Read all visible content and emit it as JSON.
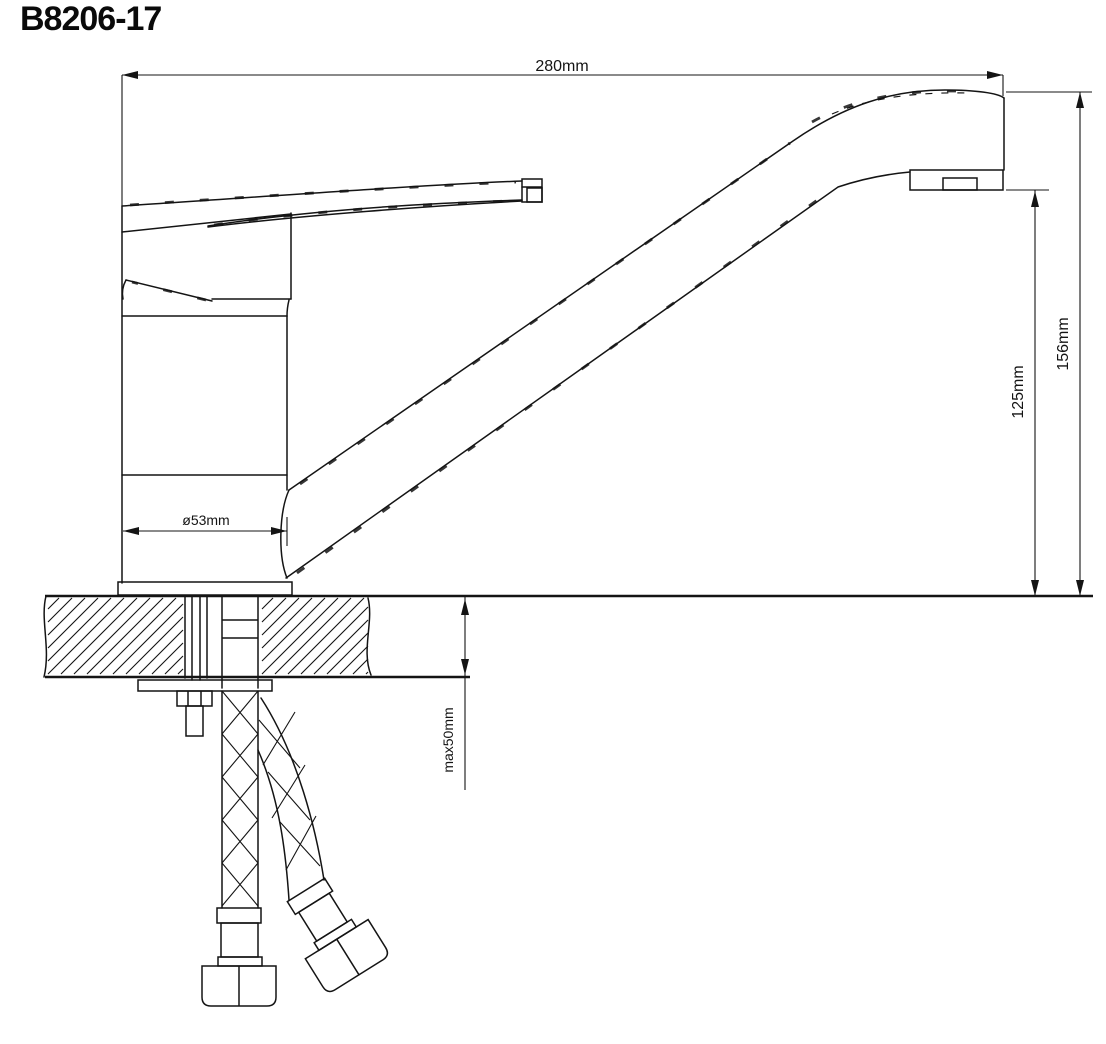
{
  "title": "B8206-17",
  "drawing_type": "faucet-installation-dimension-drawing",
  "dimensions": {
    "overall_width": "280mm",
    "total_height": "156mm",
    "spout_outlet_height": "125mm",
    "base_diameter": "ø53mm",
    "max_deck_thickness": "max50mm"
  },
  "colors": {
    "line": "#141414",
    "background": "#ffffff"
  }
}
